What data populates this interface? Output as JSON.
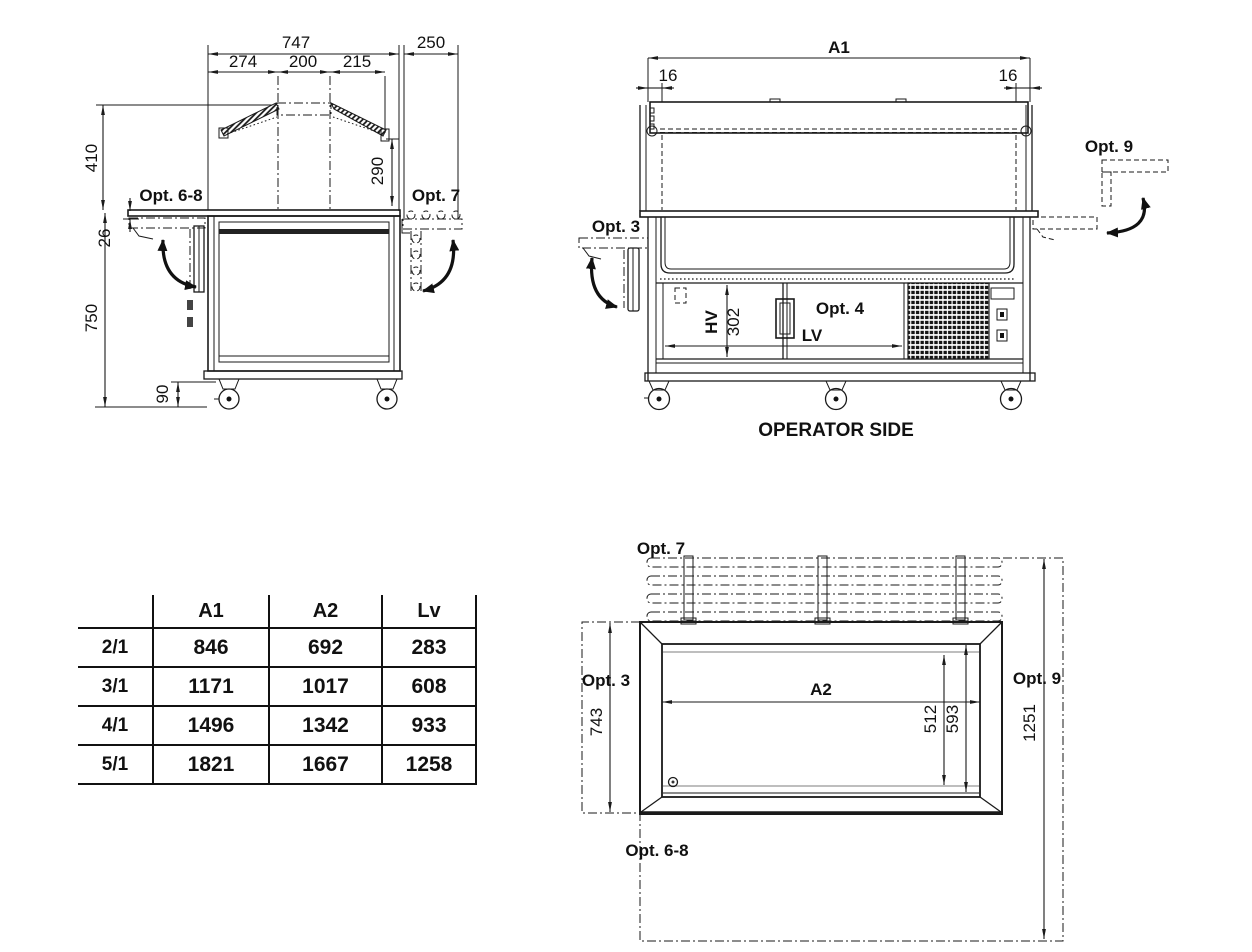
{
  "side_view": {
    "dims": {
      "total": "747",
      "rail": "250",
      "seg1": "274",
      "seg2": "200",
      "seg3": "215",
      "guard_h": "410",
      "drop": "26",
      "glass_end": "290",
      "body_h": "750",
      "caster_h": "90"
    },
    "labels": {
      "left_shelf": "Opt. 6-8",
      "right_rail": "Opt. 7"
    }
  },
  "front_view": {
    "dims": {
      "overall": "A1",
      "inset_l": "16",
      "inset_r": "16",
      "well_h_label": "HV",
      "well_h": "302",
      "well_len_label": "LV"
    },
    "labels": {
      "left_shelf": "Opt. 3",
      "compartment": "Opt. 4",
      "right_shelf": "Opt. 9",
      "caption": "OPERATOR SIDE"
    }
  },
  "top_view": {
    "dims": {
      "left_depth": "743",
      "inner_len": "A2",
      "tub_depth": "512",
      "inner_depth": "593",
      "overall_depth": "1251"
    },
    "labels": {
      "rail": "Opt. 7",
      "left_shelf": "Opt. 3",
      "right_shelf": "Opt. 9",
      "front_shelf": "Opt. 6-8"
    }
  },
  "size_table": {
    "col_headers": [
      "A1",
      "A2",
      "Lv"
    ],
    "rows": [
      {
        "model": "2/1",
        "A1": "846",
        "A2": "692",
        "Lv": "283"
      },
      {
        "model": "3/1",
        "A1": "1171",
        "A2": "1017",
        "Lv": "608"
      },
      {
        "model": "4/1",
        "A1": "1496",
        "A2": "1342",
        "Lv": "933"
      },
      {
        "model": "5/1",
        "A1": "1821",
        "A2": "1667",
        "Lv": "1258"
      }
    ]
  },
  "colors": {
    "line": "#1a1a1a",
    "light_line": "#a8a8a8",
    "background": "#ffffff"
  }
}
